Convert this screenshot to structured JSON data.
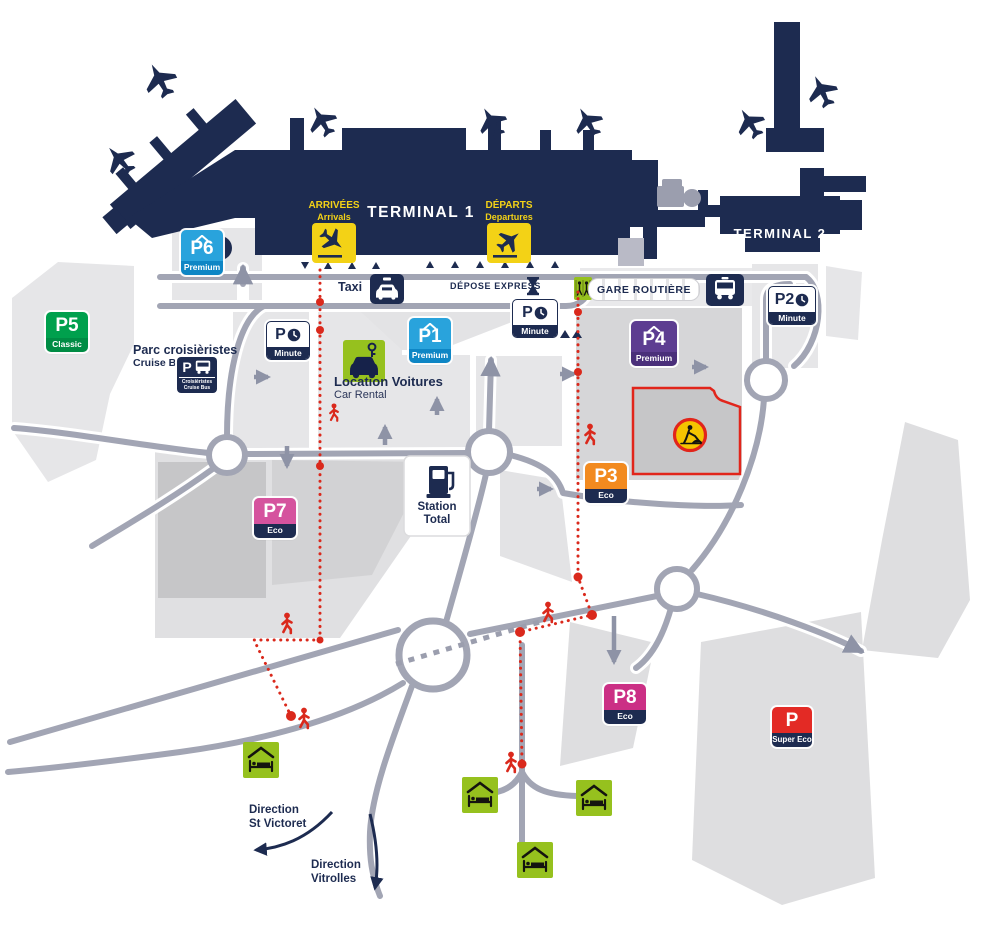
{
  "colors": {
    "navy": "#1d2b50",
    "road_grey": "#a2a5b4",
    "parcel_light": "#e6e6e8",
    "parcel_mid": "#d6d6d8",
    "parcel_dark": "#c6c6c8",
    "sign_yellow": "#f3d216",
    "lime_green": "#96c11e",
    "alert_red": "#e1251b",
    "dotted_red": "#da291c"
  },
  "terminals": {
    "t1": "TERMINAL 1",
    "t2": "TERMINAL 2"
  },
  "signs": {
    "arrivals": {
      "fr": "ARRIVÉES",
      "en": "Arrivals"
    },
    "departures": {
      "fr": "DÉPARTS",
      "en": "Departures"
    }
  },
  "transport": {
    "taxi": "Taxi",
    "depose_express": "DÉPOSE EXPRESS",
    "gare_routiere": "GARE ROUTIÈRE"
  },
  "cruise": {
    "title": "Parc croisièristes",
    "subtitle": "Cruise Bus",
    "badge_p": "P",
    "badge_line1": "Croisièristes",
    "badge_line2": "Cruise Bus"
  },
  "car_rental": {
    "fr": "Location Voitures",
    "en": "Car Rental"
  },
  "station": {
    "line1": "Station",
    "line2": "Total"
  },
  "parkings": {
    "p6": {
      "label": "P6",
      "tier": "Premium",
      "color": "#29a3dc",
      "tier_color": "#0e86c5",
      "covered": true
    },
    "p5": {
      "label": "P5",
      "tier": "Classic",
      "color": "#00a04d",
      "tier_color": "#008c44",
      "covered": false
    },
    "p1": {
      "label": "P1",
      "tier": "Premium",
      "color": "#29a3dc",
      "tier_color": "#0e86c5",
      "covered": true
    },
    "p4": {
      "label": "P4",
      "tier": "Premium",
      "color": "#5d3d91",
      "tier_color": "#4a2f7a",
      "covered": true
    },
    "p7": {
      "label": "P7",
      "tier": "Eco",
      "color": "#d5539e",
      "tier_color": "#1d2b50",
      "covered": false
    },
    "p3": {
      "label": "P3",
      "tier": "Eco",
      "color": "#f28a1f",
      "tier_color": "#1d2b50",
      "covered": false
    },
    "p8": {
      "label": "P8",
      "tier": "Eco",
      "color": "#cb2f85",
      "tier_color": "#1d2b50",
      "covered": false
    },
    "psuper": {
      "label": "P",
      "tier": "Super Eco",
      "color": "#e32a25",
      "tier_color": "#1d2b50",
      "covered": false
    }
  },
  "minute": {
    "m1": {
      "label": "P",
      "tier": "Minute"
    },
    "m2": {
      "label": "P",
      "tier": "Minute"
    },
    "p2": {
      "label": "P2",
      "tier": "Minute"
    }
  },
  "directions": {
    "st_victoret": {
      "line1": "Direction",
      "line2": "St Victoret"
    },
    "vitrolles": {
      "line1": "Direction",
      "line2": "Vitrolles"
    }
  },
  "icons": {
    "plane": "plane-icon",
    "landing": "plane-landing-icon",
    "takeoff": "plane-takeoff-icon",
    "taxi": "taxi-car-icon",
    "bus": "bus-icon",
    "hourglass": "hourglass-icon",
    "crossing": "pedestrian-crossing-icon",
    "car_rental": "car-rental-key-icon",
    "fuel": "fuel-pump-icon",
    "roadworks": "roadworks-icon",
    "hotel": "hotel-bed-icon",
    "pedestrian": "red-pedestrian-icon",
    "clock": "clock-icon",
    "roof": "covered-parking-roof-icon"
  }
}
